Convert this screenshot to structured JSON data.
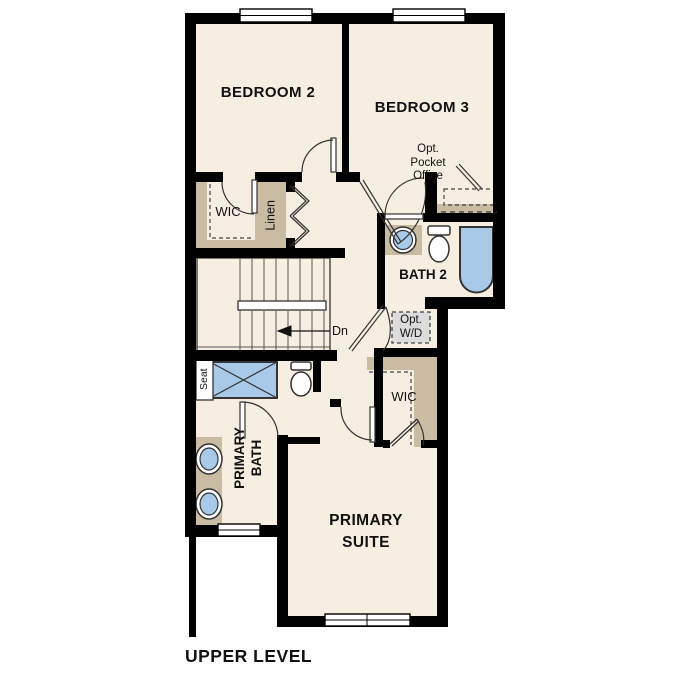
{
  "plan_title": "UPPER LEVEL",
  "rooms": {
    "bedroom2": "BEDROOM 2",
    "bedroom3": "BEDROOM 3",
    "bath2": "BATH 2",
    "primary_bath_line1": "PRIMARY",
    "primary_bath_line2": "BATH",
    "primary_suite_line1": "PRIMARY",
    "primary_suite_line2": "SUITE",
    "wic_upper": "WIC",
    "wic_lower": "WIC",
    "linen": "Linen",
    "seat": "Seat"
  },
  "annotations": {
    "pocket_office_line1": "Opt.",
    "pocket_office_line2": "Pocket",
    "pocket_office_line3": "Office",
    "washer_dryer_line1": "Opt.",
    "washer_dryer_line2": "W/D",
    "stairs_direction": "Dn"
  },
  "fixtures": [
    "shower with seat",
    "toilet",
    "double vanity sinks",
    "bathtub",
    "pedestal sink",
    "stairs down",
    "windows",
    "optional washer dryer",
    "optional pocket office desk"
  ],
  "colors": {
    "wall": "#000000",
    "floor": "#f6eee1",
    "casework_tan": "#c9bca2",
    "fixture_blue": "#a9c9e9",
    "optional_gray": "#dcdcdc",
    "line": "#333333",
    "text": "#111111"
  }
}
